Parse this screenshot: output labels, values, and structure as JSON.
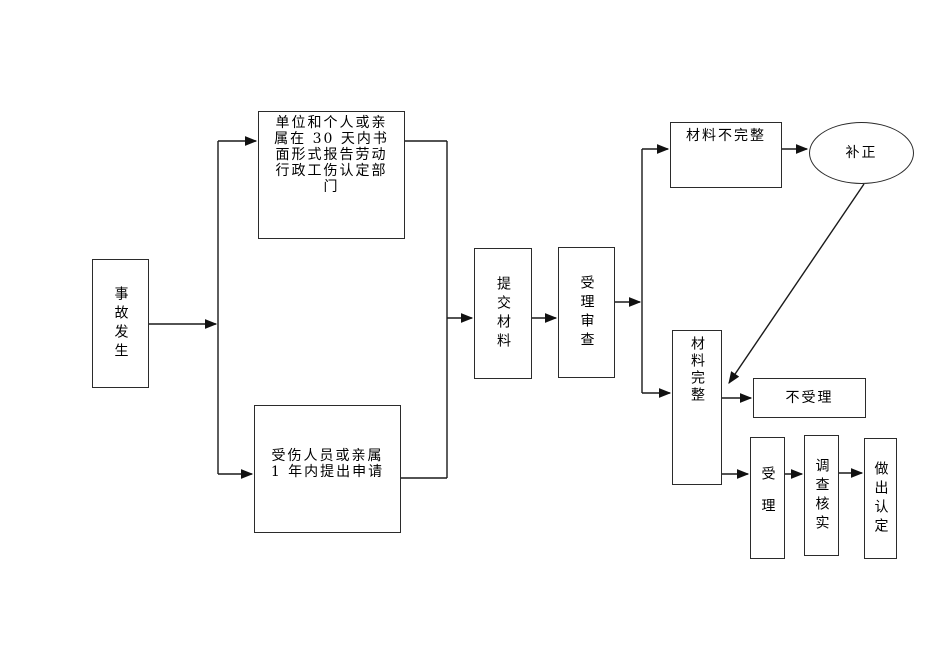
{
  "diagram": {
    "background_color": "#ffffff",
    "line_color": "#1a1a1a",
    "text_color": "#000000",
    "nodes": {
      "accident": {
        "label": "事故发生",
        "shape": "rectangle"
      },
      "unit_report": {
        "label": "单位和个人或亲\n属在 30 天内书\n面形式报告劳动\n行政工伤认定部\n门",
        "shape": "rectangle"
      },
      "injured_apply": {
        "label": "受伤人员或亲属\n1 年内提出申请",
        "shape": "rectangle"
      },
      "submit_materials": {
        "label": "提交材料",
        "shape": "rectangle"
      },
      "acceptance_review": {
        "label": "受理审查",
        "shape": "rectangle"
      },
      "materials_incomplete": {
        "label": "材料不完整",
        "shape": "rectangle"
      },
      "supplement": {
        "label": "补正",
        "shape": "ellipse"
      },
      "materials_complete": {
        "label": "材料完整",
        "shape": "rectangle"
      },
      "not_accepted": {
        "label": "不受理",
        "shape": "rectangle"
      },
      "accept": {
        "label": "受理",
        "shape": "rectangle"
      },
      "investigate_verify": {
        "label": "调查核实",
        "shape": "rectangle"
      },
      "make_determination": {
        "label": "做出认定",
        "shape": "rectangle"
      }
    },
    "edges": [
      {
        "from": "accident",
        "to": "branch-line",
        "arrow": true
      },
      {
        "from": "branch-line",
        "to": "unit_report",
        "arrow": true
      },
      {
        "from": "branch-line",
        "to": "injured_apply",
        "arrow": true
      },
      {
        "from": "unit_report",
        "to": "merge-line",
        "arrow": false
      },
      {
        "from": "injured_apply",
        "to": "merge-line",
        "arrow": false
      },
      {
        "from": "merge-line",
        "to": "submit_materials",
        "arrow": true
      },
      {
        "from": "submit_materials",
        "to": "acceptance_review",
        "arrow": true
      },
      {
        "from": "acceptance_review",
        "to": "result-branch-line",
        "arrow": true
      },
      {
        "from": "result-branch-line",
        "to": "materials_incomplete",
        "arrow": true
      },
      {
        "from": "result-branch-line",
        "to": "materials_complete",
        "arrow": true
      },
      {
        "from": "materials_incomplete",
        "to": "supplement",
        "arrow": true
      },
      {
        "from": "supplement",
        "to": "materials_complete",
        "arrow": true
      },
      {
        "from": "materials_complete",
        "to": "not_accepted",
        "arrow": true
      },
      {
        "from": "materials_complete",
        "to": "accept",
        "arrow": true
      },
      {
        "from": "accept",
        "to": "investigate_verify",
        "arrow": true
      },
      {
        "from": "investigate_verify",
        "to": "make_determination",
        "arrow": true
      }
    ]
  }
}
